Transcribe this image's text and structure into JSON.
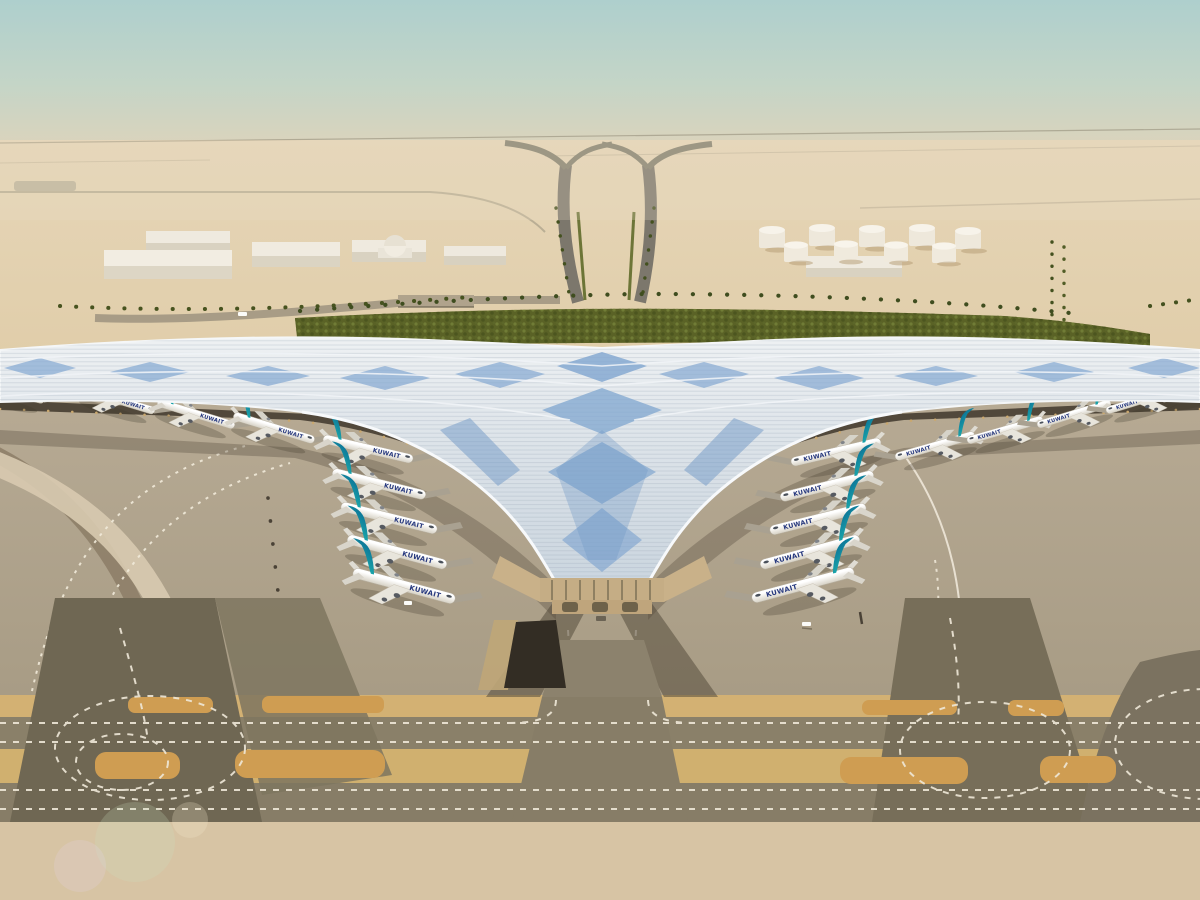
{
  "scene": {
    "description": "Aerial rendering of a desert airport with a trident-shaped terminal under an undulating solar roof, aircraft parked at gates, taxiways in the foreground",
    "airline_label": "KUWAIT"
  },
  "palette": {
    "sky_top": "#aecfcd",
    "horizon_haze": "#ddd3bb",
    "desert_sand": "#ddc6a2",
    "apron_concrete": "#b2a58f",
    "taxiway_asphalt": "#897f68",
    "painted_shoulder": "#cf9d52",
    "sand_strip": "#d3b173",
    "roof_silver": "#e9edf0",
    "roof_solar_blue": "#7fa5cf",
    "landscape_green": "#5a6226",
    "aircraft_fin_teal": "#18a0a8",
    "aircraft_title_blue": "#26387e"
  }
}
